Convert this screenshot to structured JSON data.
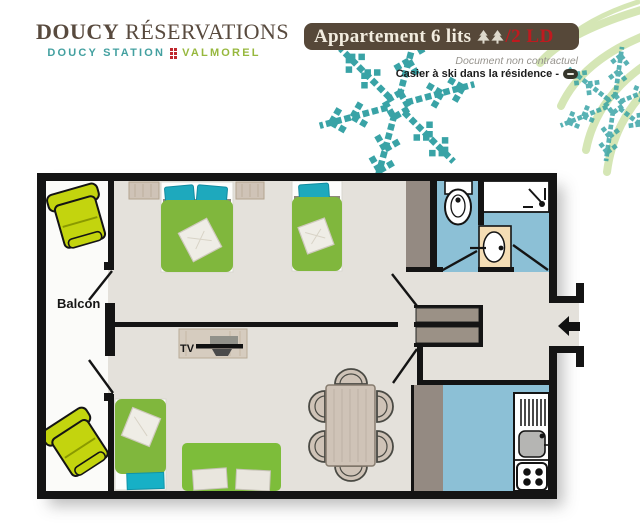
{
  "brand": {
    "name_bold": "DOUCY",
    "name_rest": "RÉSERVATIONS",
    "station": "DOUCY STATION",
    "resort": "VALMOREL"
  },
  "banner": {
    "title": "Appartement 6 lits",
    "capacity": "/2 LD",
    "tree_count": 2
  },
  "notes": {
    "disclaimer": "Document non contractuel",
    "ski": "Casier à ski dans la résidence -"
  },
  "plan": {
    "balcony_label": "Balcon",
    "tv_label": "TV"
  },
  "colors": {
    "brand_brown": "#584a3e",
    "station_teal": "#43a0a0",
    "resort_green": "#97b83e",
    "banner_bg": "#564839",
    "banner_text": "#f2ecdf",
    "accent_red": "#bf1a1f",
    "wall": "#141414",
    "floor": "#e4e1db",
    "balcony_floor": "#fbfbf9",
    "wet_room_floor": "#8cc0d6",
    "bed_green": "#80b73d",
    "pillow_teal": "#1ea9bd",
    "chair_lime": "#c3d40e",
    "wood": "#cfc3b7",
    "taupe_wall": "#948a82",
    "snowflake_teal": "#2f9fa2",
    "frond_green": "#d3e5b2"
  }
}
